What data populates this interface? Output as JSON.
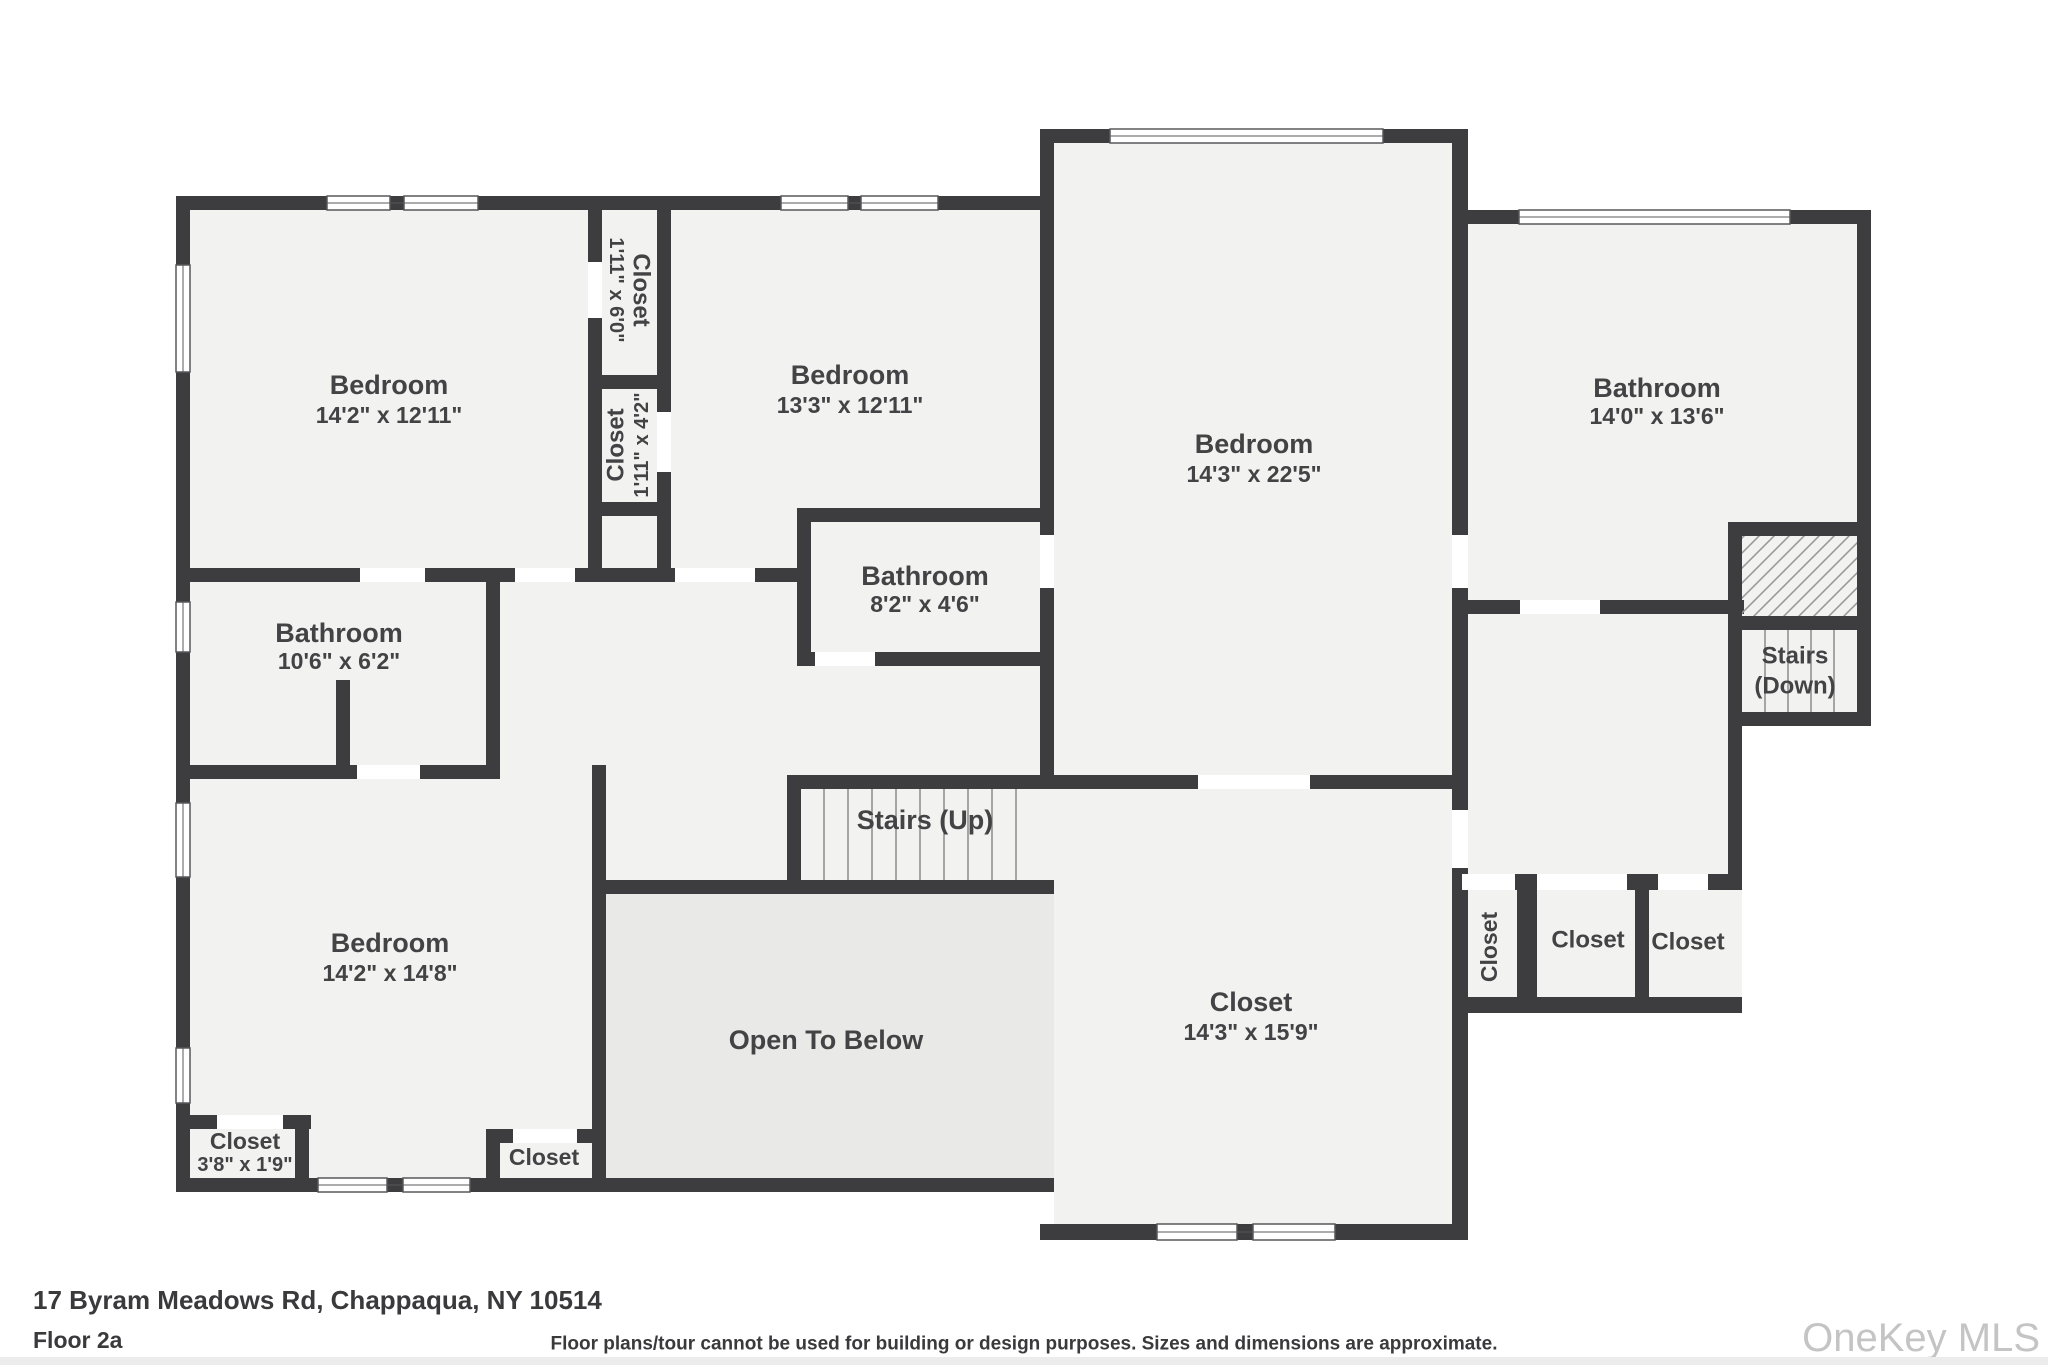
{
  "footer": {
    "address": "17 Byram Meadows Rd, Chappaqua, NY 10514",
    "floor_label": "Floor 2a",
    "disclaimer": "Floor plans/tour cannot be used for building or design purposes. Sizes and dimensions are approximate.",
    "watermark": "OneKey MLS"
  },
  "colors": {
    "wall": "#3d3d3f",
    "room_fill": "#f2f2f1",
    "open_to_below_fill": "#e9e9e8",
    "label_text": "#434345",
    "watermark_text": "#c4c4c4",
    "footer_text": "#3a3a3c",
    "hatch_line": "#9a9a9c",
    "stair_tread_line": "#8b8b8d",
    "window_outline": "#58585a",
    "footer_strip": "#ececec"
  },
  "rooms": {
    "bedroom_top_left": {
      "name": "Bedroom",
      "dims": "14'2\" x 12'11\""
    },
    "closet_upper": {
      "name": "Closet",
      "dims": "1'11\" x 6'0\""
    },
    "closet_lower": {
      "name": "Closet",
      "dims": "1'11\" x 4'2\""
    },
    "bedroom_top_middle": {
      "name": "Bedroom",
      "dims": "13'3\" x 12'11\""
    },
    "bathroom_middle": {
      "name": "Bathroom",
      "dims": "8'2\" x 4'6\""
    },
    "bedroom_tall": {
      "name": "Bedroom",
      "dims": "14'3\" x 22'5\""
    },
    "bathroom_right": {
      "name": "Bathroom",
      "dims": "14'0\" x 13'6\""
    },
    "bathroom_left": {
      "name": "Bathroom",
      "dims": "10'6\" x 6'2\""
    },
    "bedroom_bottom_left": {
      "name": "Bedroom",
      "dims": "14'2\" x 14'8\""
    },
    "closet_bottom_left": {
      "name": "Closet",
      "dims": "3'8\" x 1'9\""
    },
    "closet_bottom_mid": {
      "name": "Closet"
    },
    "stairs_up": {
      "name": "Stairs (Up)"
    },
    "open_to_below": {
      "name": "Open To Below"
    },
    "closet_room": {
      "name": "Closet",
      "dims": "14'3\" x 15'9\""
    },
    "stairs_down": {
      "name": "Stairs",
      "name2": "(Down)"
    },
    "closet_right_1": {
      "name": "Closet"
    },
    "closet_right_2": {
      "name": "Closet"
    },
    "closet_right_3": {
      "name": "Closet"
    }
  }
}
